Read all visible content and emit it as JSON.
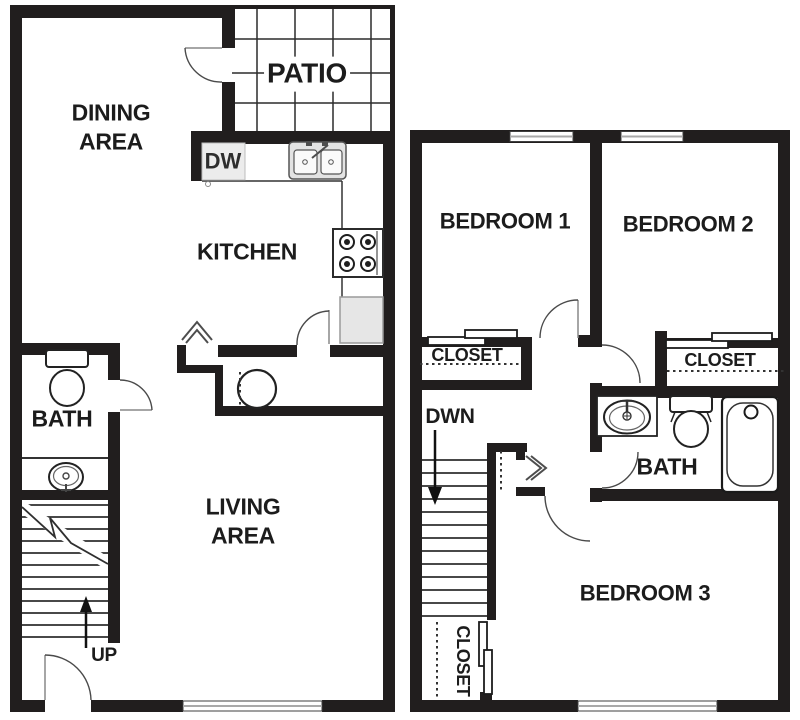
{
  "colors": {
    "wall": "#211e1e",
    "thin_line": "#333333",
    "door_arc": "#4a4a4a",
    "fixture_gray": "#e9e9e9",
    "text": "#1c1c1c",
    "background": "#ffffff"
  },
  "first_floor": {
    "dining": {
      "line1": "DINING",
      "line2": "AREA"
    },
    "patio": {
      "label": "PATIO"
    },
    "kitchen": {
      "label": "KITCHEN",
      "dishwasher": "DW",
      "fixtures": [
        "dishwasher",
        "double-sink",
        "stove",
        "refrigerator",
        "counter"
      ]
    },
    "bath": {
      "label": "BATH",
      "fixtures": [
        "toilet",
        "sink"
      ]
    },
    "living": {
      "line1": "LIVING",
      "line2": "AREA"
    },
    "stairs": {
      "label": "UP",
      "direction": "up"
    },
    "utility": {
      "fixtures": [
        "water-heater",
        "bifold-closet-door"
      ]
    },
    "openings": [
      "patio-door",
      "kitchen-door",
      "bath-door",
      "entry-door",
      "window"
    ]
  },
  "second_floor": {
    "bedroom1": {
      "label": "BEDROOM 1",
      "closet": "CLOSET"
    },
    "bedroom2": {
      "label": "BEDROOM 2",
      "closet": "CLOSET"
    },
    "bedroom3": {
      "label": "BEDROOM 3",
      "closet": "CLOSET"
    },
    "bath": {
      "label": "BATH",
      "fixtures": [
        "sink-vanity",
        "toilet",
        "bathtub"
      ]
    },
    "stairs": {
      "label": "DWN",
      "direction": "down"
    },
    "openings": [
      "bedroom1-door",
      "bedroom2-door",
      "bath-door",
      "bedroom3-door",
      "windows"
    ]
  }
}
